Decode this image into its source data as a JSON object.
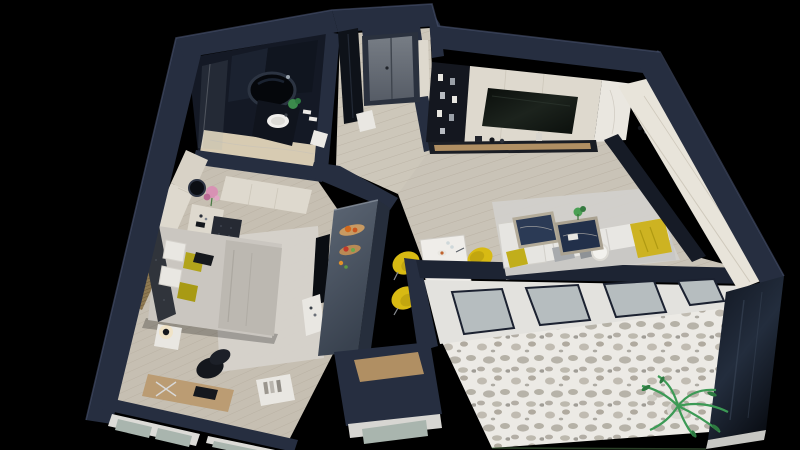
{
  "meta": {
    "title": "3D apartment floor plan render",
    "view": "isometric top-down cutaway",
    "canvas": {
      "width": 800,
      "height": 450
    },
    "background": "black"
  },
  "palette": {
    "background": "#000000",
    "wall-top": "#262e40",
    "wall-face": "#151a26",
    "wall-highlight": "#4a5470",
    "wood-floor": "#c9c3b7",
    "wood-plank-line": "#a79e8e",
    "bedroom-floor": "#c6bfb2",
    "marble-floor": "#d7cbb2",
    "terrazzo-base": "#eceae5",
    "terrazzo-fleck": "#a8a296",
    "rug": "#d6d2cb",
    "cream-cabinet": "#ded9ce",
    "dark-furniture": "#14171f",
    "counter-top": "#5e6876",
    "counter-bottom": "#39424f",
    "accent-yellow": "#d8ba13",
    "accent-olive": "#b2a41b",
    "sofa-light": "#e8e7e3",
    "plant-green": "#3c9a55",
    "glass": "#b6bdbf",
    "glass-exterior": "#a9b5ae",
    "door-gray": "#6f757c",
    "tv-screen": "#0d120e",
    "coffee-table-marble": "#2b3a55",
    "pink-flowers": "#d892b4",
    "food-orange": "#d2691e",
    "wood-accent": "#b08f63"
  },
  "scene": {
    "type": "apartment-3d-floorplan",
    "rooms": [
      {
        "id": "bathroom",
        "furniture": [
          "round-black-bathtub",
          "dark-vanity",
          "white-sink",
          "toilet",
          "shower-glass",
          "small-plant",
          "towels"
        ]
      },
      {
        "id": "entry-hall",
        "furniture": [
          "gray-double-door",
          "tall-dark-cabinet",
          "white-stool"
        ]
      },
      {
        "id": "bedroom",
        "furniture": [
          "double-bed",
          "tufted-headboard",
          "white-pillows",
          "yellow-pillows",
          "wardrobe-wall",
          "wood-slat-wall",
          "round-mirror",
          "pink-flowers",
          "cream-dresser",
          "tufted-ottoman",
          "nightstand",
          "table-lamp",
          "desk",
          "laptop",
          "office-chair",
          "bookshelf",
          "wall-tv",
          "tv-cabinet",
          "area-rug",
          "bay-windows"
        ]
      },
      {
        "id": "kitchen",
        "furniture": [
          "island-counter",
          "cutting-boards-with-food",
          "black-shelving-unit",
          "tv-wall-unit",
          "wall-tv",
          "media-ledge",
          "marble-panel"
        ]
      },
      {
        "id": "living-room",
        "furniture": [
          "corner-sofa",
          "white-cushions",
          "yellow-throw",
          "yellow-pillow",
          "fur-pillow",
          "marble-coffee-tables",
          "table-plant",
          "area-rug",
          "dining-table",
          "yellow-shell-chairs",
          "tableware",
          "cream-wardrobe-wall",
          "window-wall"
        ]
      },
      {
        "id": "balcony",
        "furniture": [
          "terrazzo-floor",
          "potted-plant",
          "glass-railing"
        ]
      }
    ]
  }
}
